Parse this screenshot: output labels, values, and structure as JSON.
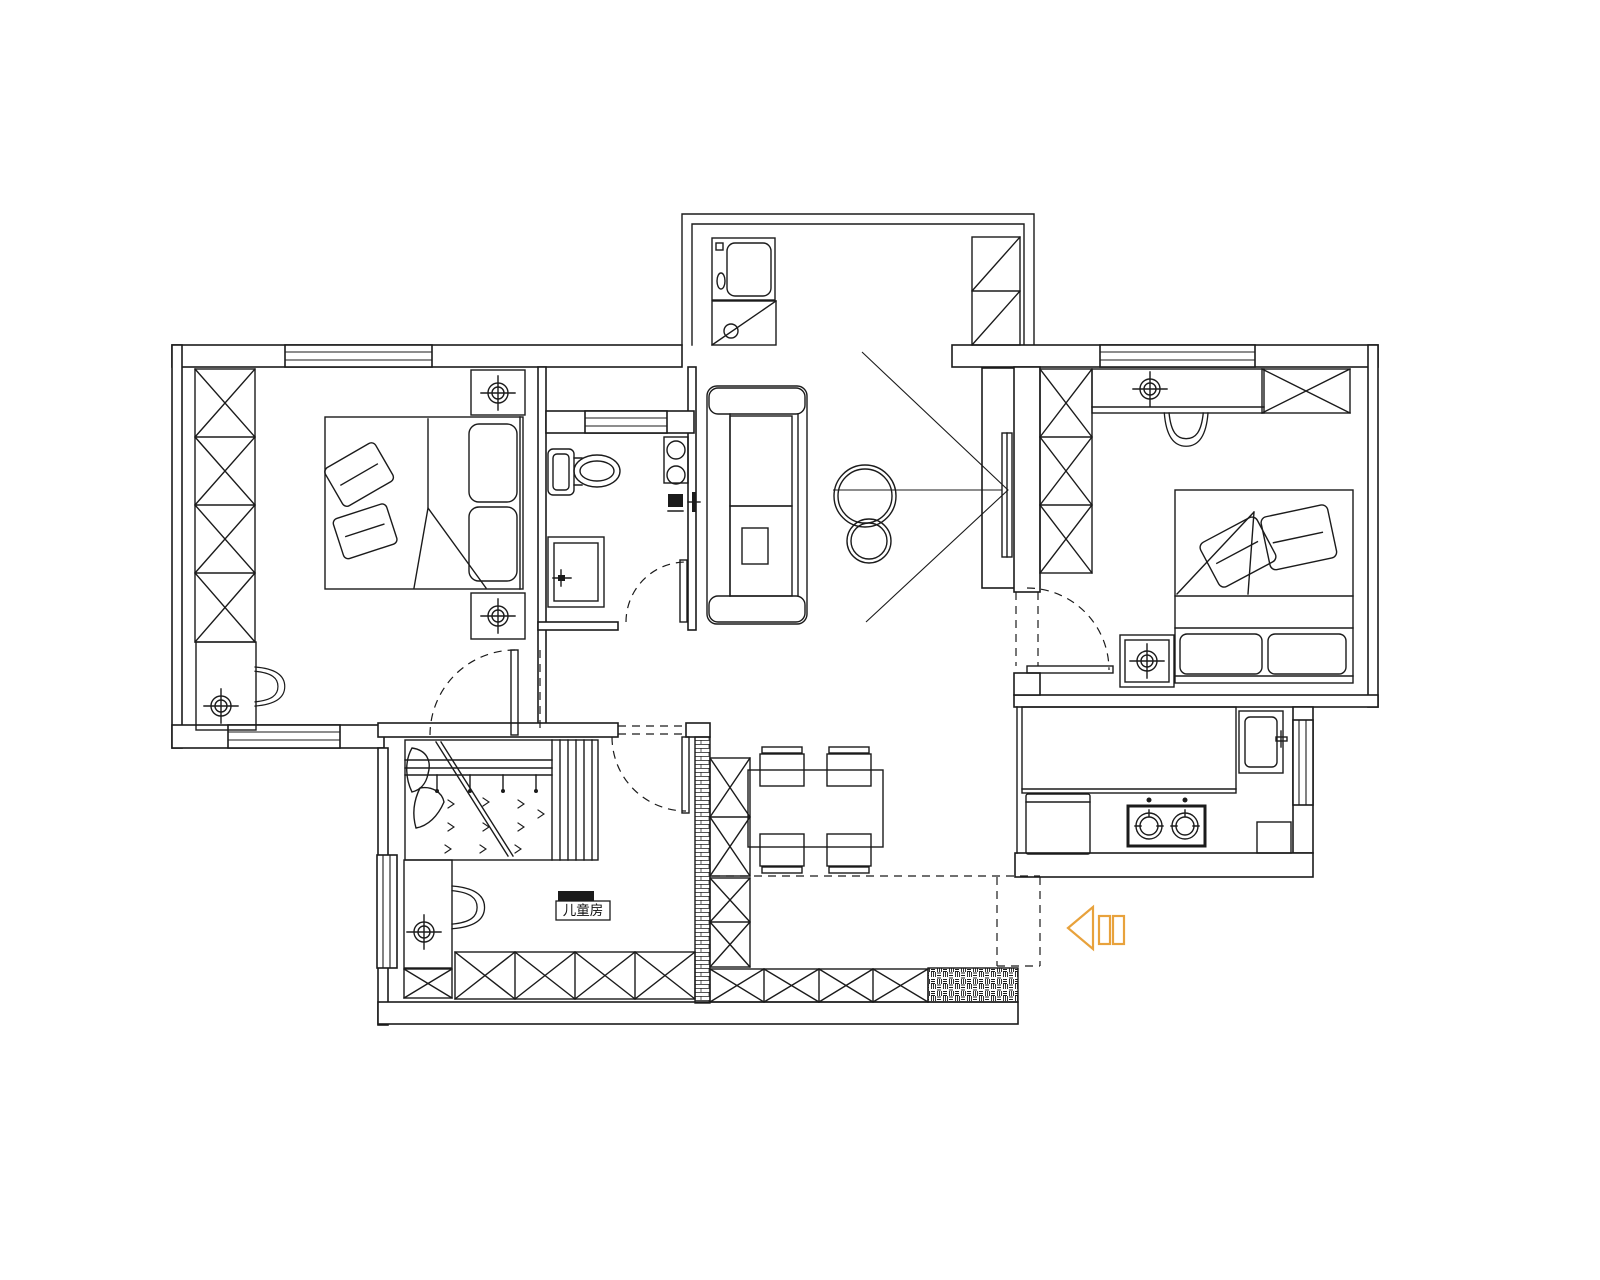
{
  "page": {
    "type": "cad-floor-plan",
    "background": "#ffffff"
  },
  "colors": {
    "line": "#1b1b1b",
    "entry_arrow": "#e8a23c",
    "paper": "#ffffff"
  },
  "labels": {
    "children_room": "儿童房"
  }
}
